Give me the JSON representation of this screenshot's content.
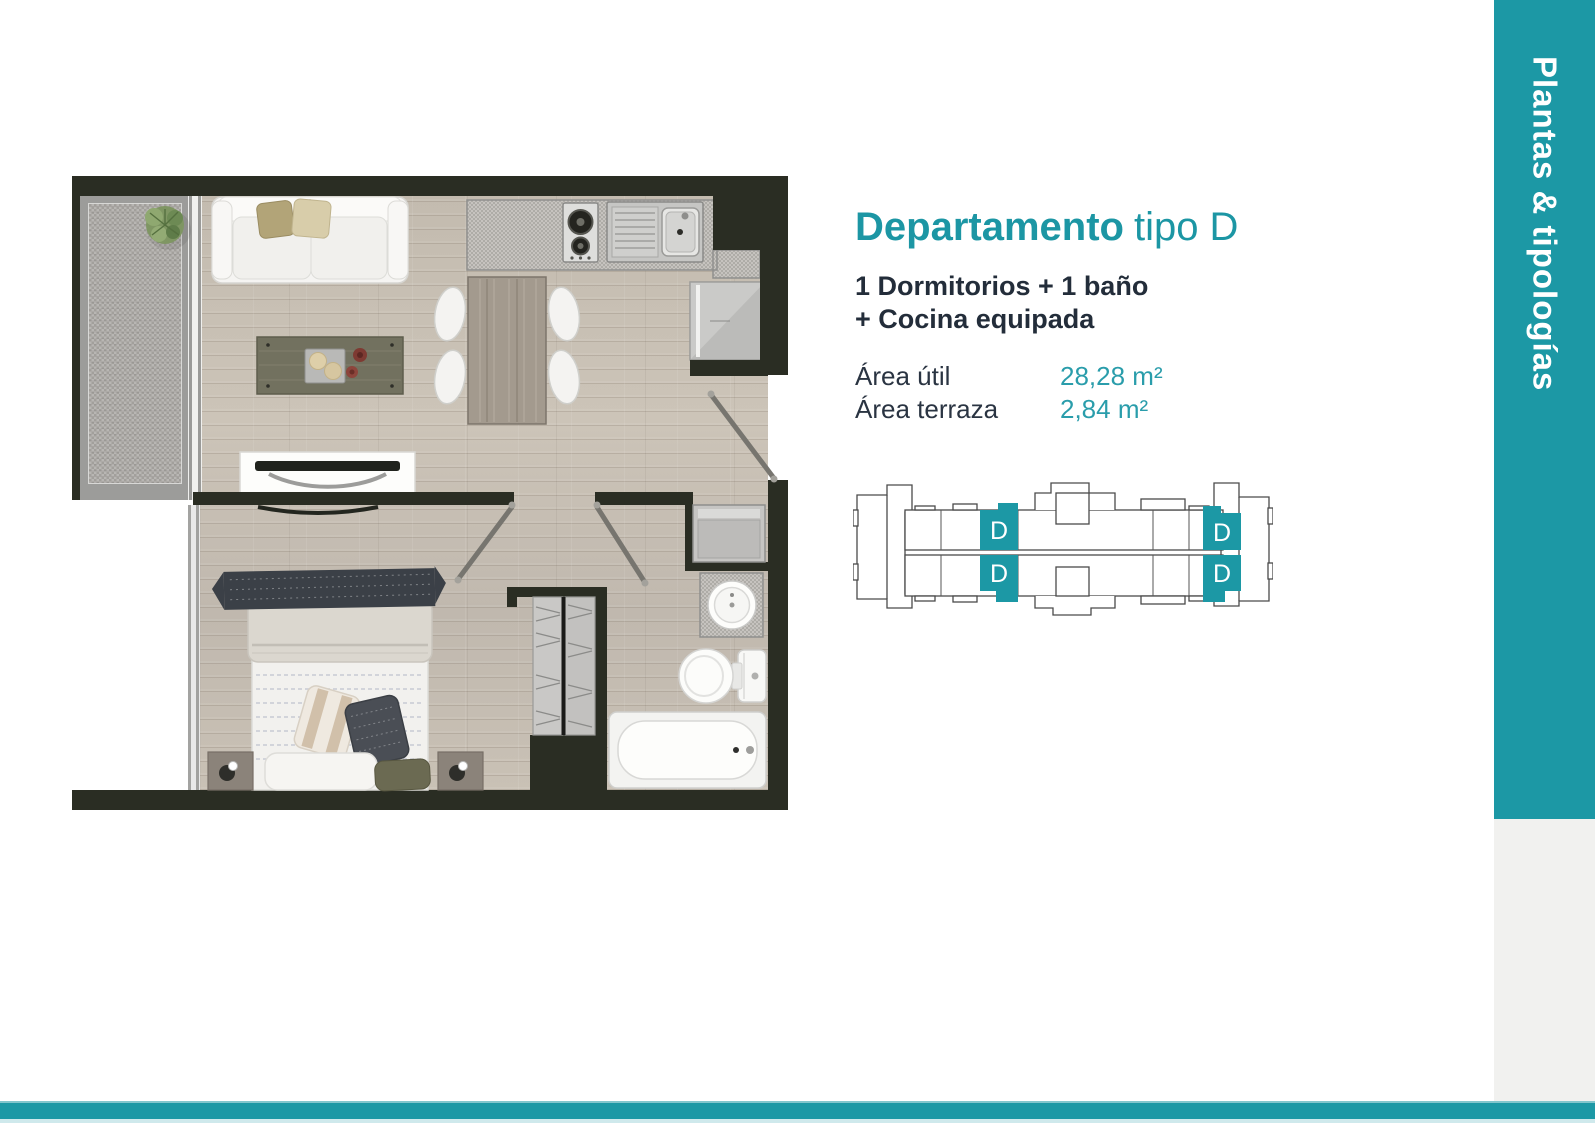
{
  "colors": {
    "accent": "#1c98a5",
    "accent_pale": "#cfe9ec",
    "wall": "#2a2d23",
    "ink": "#232d3a",
    "value_teal": "#2a9dab"
  },
  "sidebar": {
    "label": "Plantas & tipologías"
  },
  "apartment": {
    "title_bold": "Departamento",
    "title_light": "tipo D",
    "subtitle_line1": "1 Dormitorios + 1 baño",
    "subtitle_line2": "+ Cocina equipada",
    "areas": [
      {
        "label": "Área útil",
        "value": "28,28 m²"
      },
      {
        "label": "Área terraza",
        "value": "2,84 m²"
      }
    ]
  },
  "keyplan": {
    "unit_label": "D"
  }
}
